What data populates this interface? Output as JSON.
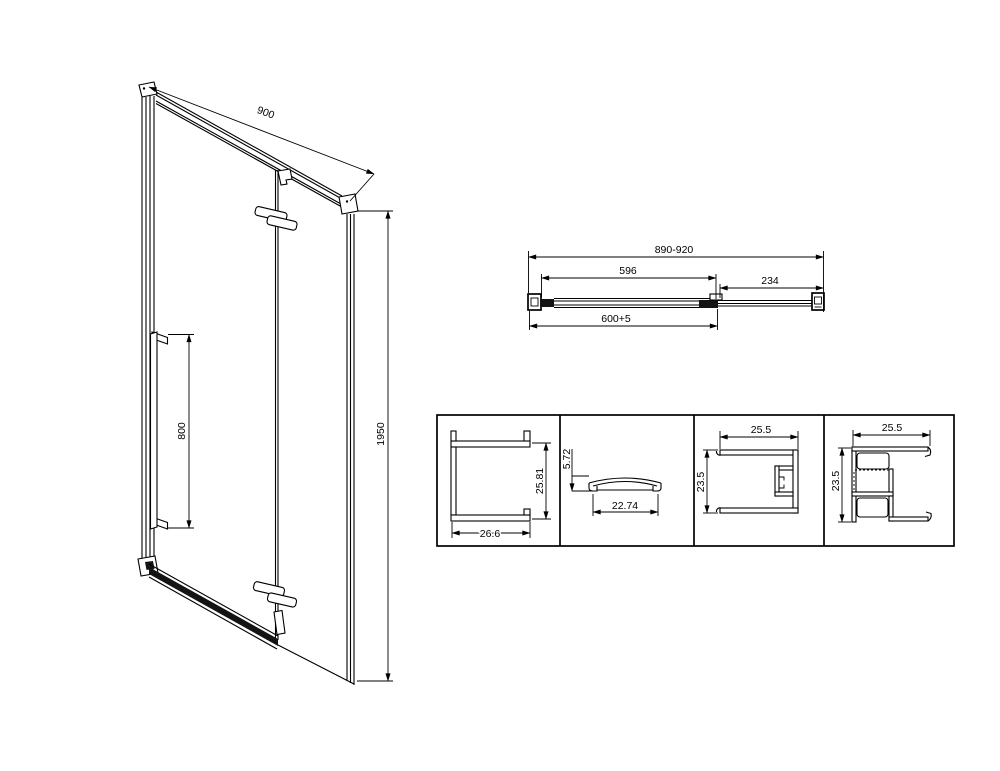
{
  "isometric_view": {
    "width": "900",
    "handle_height": "800",
    "height": "1950"
  },
  "plan_view": {
    "overall_width": "890-920",
    "glass_width": "596",
    "extension_width": "234",
    "bar_width": "600+5"
  },
  "profiles": [
    {
      "name": "glass-channel-profile",
      "height": "25.81",
      "width": "26.6"
    },
    {
      "name": "cover-cap-profile",
      "height": "5.72",
      "width": "22.74"
    },
    {
      "name": "wall-profile",
      "width": "25.5",
      "height": "23.5"
    },
    {
      "name": "extension-profile",
      "width": "25.5",
      "height": "23.5"
    }
  ],
  "colors": {
    "line": "#000000",
    "background": "#ffffff"
  }
}
